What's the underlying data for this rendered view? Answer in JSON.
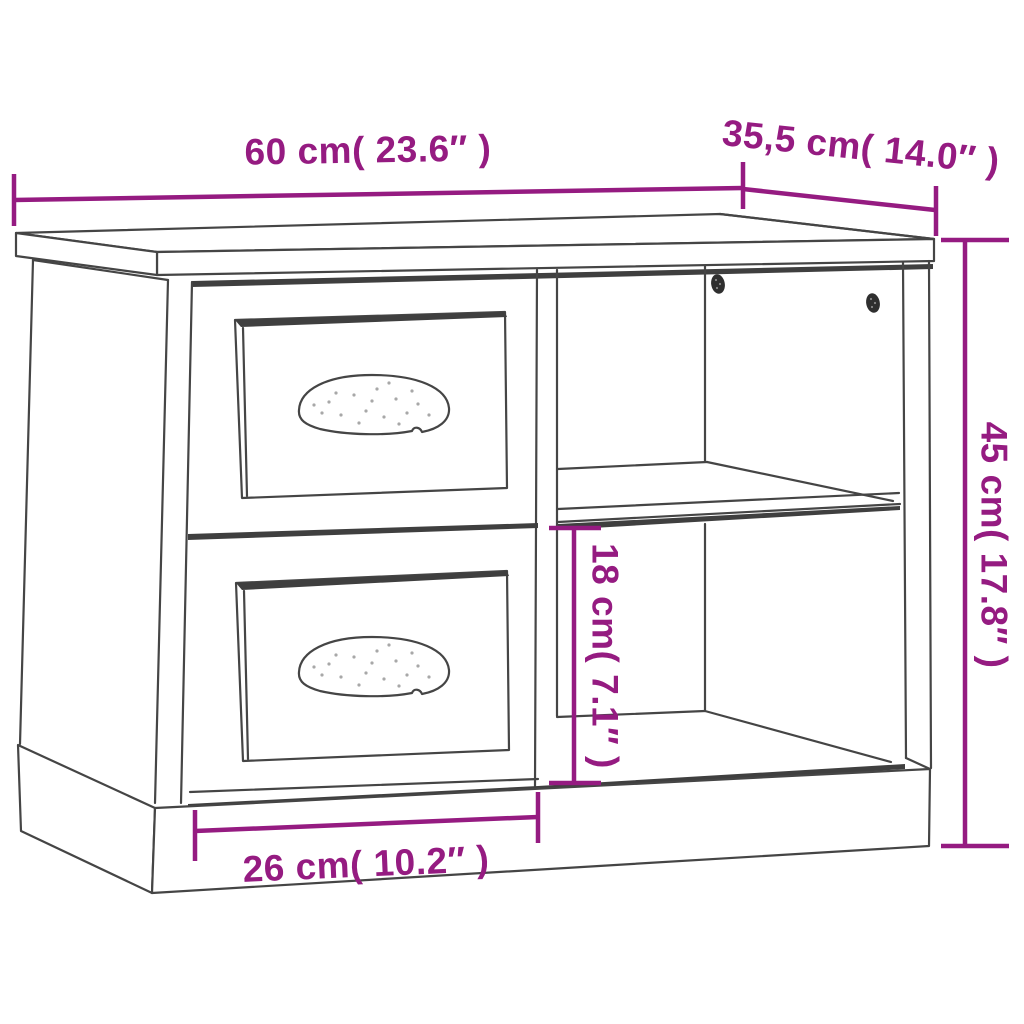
{
  "diagram": {
    "subject": "nightstand-line-drawing",
    "colors": {
      "accent": "#951b81",
      "outline": "#454545",
      "background": "#ffffff"
    },
    "dimension_labels": {
      "width": "60 cm( 23.6″ )",
      "depth": "35,5 cm( 14.0″ )",
      "height": "45 cm( 17.8″ )",
      "shelf_inner_height": "18 cm( 7.1″ )",
      "drawer_width": "26 cm( 10.2″ )"
    }
  }
}
